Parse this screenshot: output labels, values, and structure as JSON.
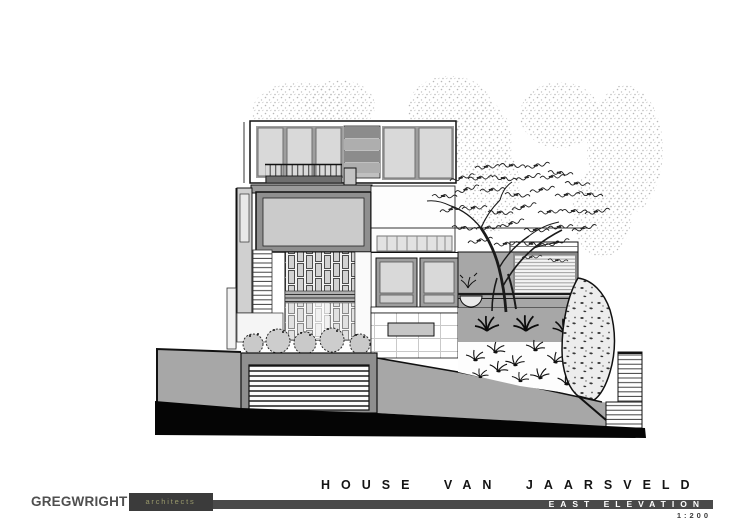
{
  "page": {
    "background_color": "#ffffff"
  },
  "logo": {
    "firm_name": "GREGWRIGHT",
    "firm_suffix": "architects",
    "name_color": "#4f4f4f",
    "suffix_color": "#99996b",
    "block_color": "#3b3b3b"
  },
  "title_block": {
    "project_title": "HOUSE VAN JAARSVELD",
    "drawing_title": "EAST ELEVATION",
    "scale": "1:200",
    "bar_color": "#4a4a4a",
    "project_title_color": "#141414",
    "drawing_title_color": "#ffffff",
    "scale_color": "#3a3a3a"
  },
  "drawing": {
    "kind": "architectural-east-elevation",
    "palette": {
      "glazing": "#d9d9d9",
      "louvers_dark": "#8c8c8c",
      "walls_mid_gray": "#8f8f8f",
      "earth_bank": "#a7a7a7",
      "ground_cut": "#050505",
      "line_work": "#111111"
    },
    "elements": [
      "background-trees",
      "top-floor-glazing",
      "roof-louvers",
      "balcony-railing",
      "external-stair",
      "mid-floor-panel",
      "brick-screen",
      "casement-windows",
      "small-window-strip",
      "garden-wall",
      "louvre-screen",
      "planter-bowl",
      "tiled-wall",
      "recessed-panel",
      "feature-tree",
      "aloe-plants",
      "planted-slope",
      "rock-boulder",
      "site-stairs",
      "shrubs",
      "garage-door",
      "earth-banks",
      "ground-cut-line"
    ]
  }
}
